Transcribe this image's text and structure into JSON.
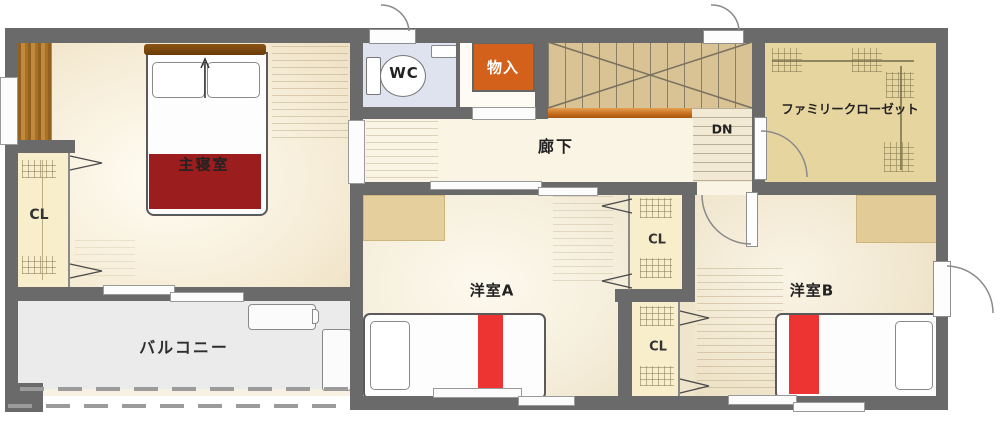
{
  "rooms": {
    "master_bedroom": {
      "label": "主寝室"
    },
    "master_closet": {
      "label": "CL"
    },
    "wc": {
      "label": "WC"
    },
    "storage": {
      "label": "物入"
    },
    "hallway": {
      "label": "廊下"
    },
    "stairs_down": {
      "label": "DN"
    },
    "family_closet": {
      "label": "ファミリークローゼット"
    },
    "room_a": {
      "label": "洋室A"
    },
    "room_a_closet": {
      "label": "CL"
    },
    "room_b": {
      "label": "洋室B"
    },
    "room_b_closet": {
      "label": "CL"
    },
    "balcony": {
      "label": "バルコニー"
    }
  },
  "colors": {
    "wall": "#6a6a6a",
    "storage_accent": "#d4611b",
    "stair_handrail": "#c8701f",
    "master_blanket_red": "#9c1d1d",
    "single_bed_stripe_red": "#ee3432",
    "headboard_brown": "#7d4a12",
    "closet_floor": "#f8eecb",
    "family_closet_floor": "#e7d5a0",
    "stairs_floor": "#d9c294",
    "wc_floor": "#dfe3ef",
    "balcony_floor": "#ebebeb",
    "bedroom_floor": "#f6ecd6"
  }
}
